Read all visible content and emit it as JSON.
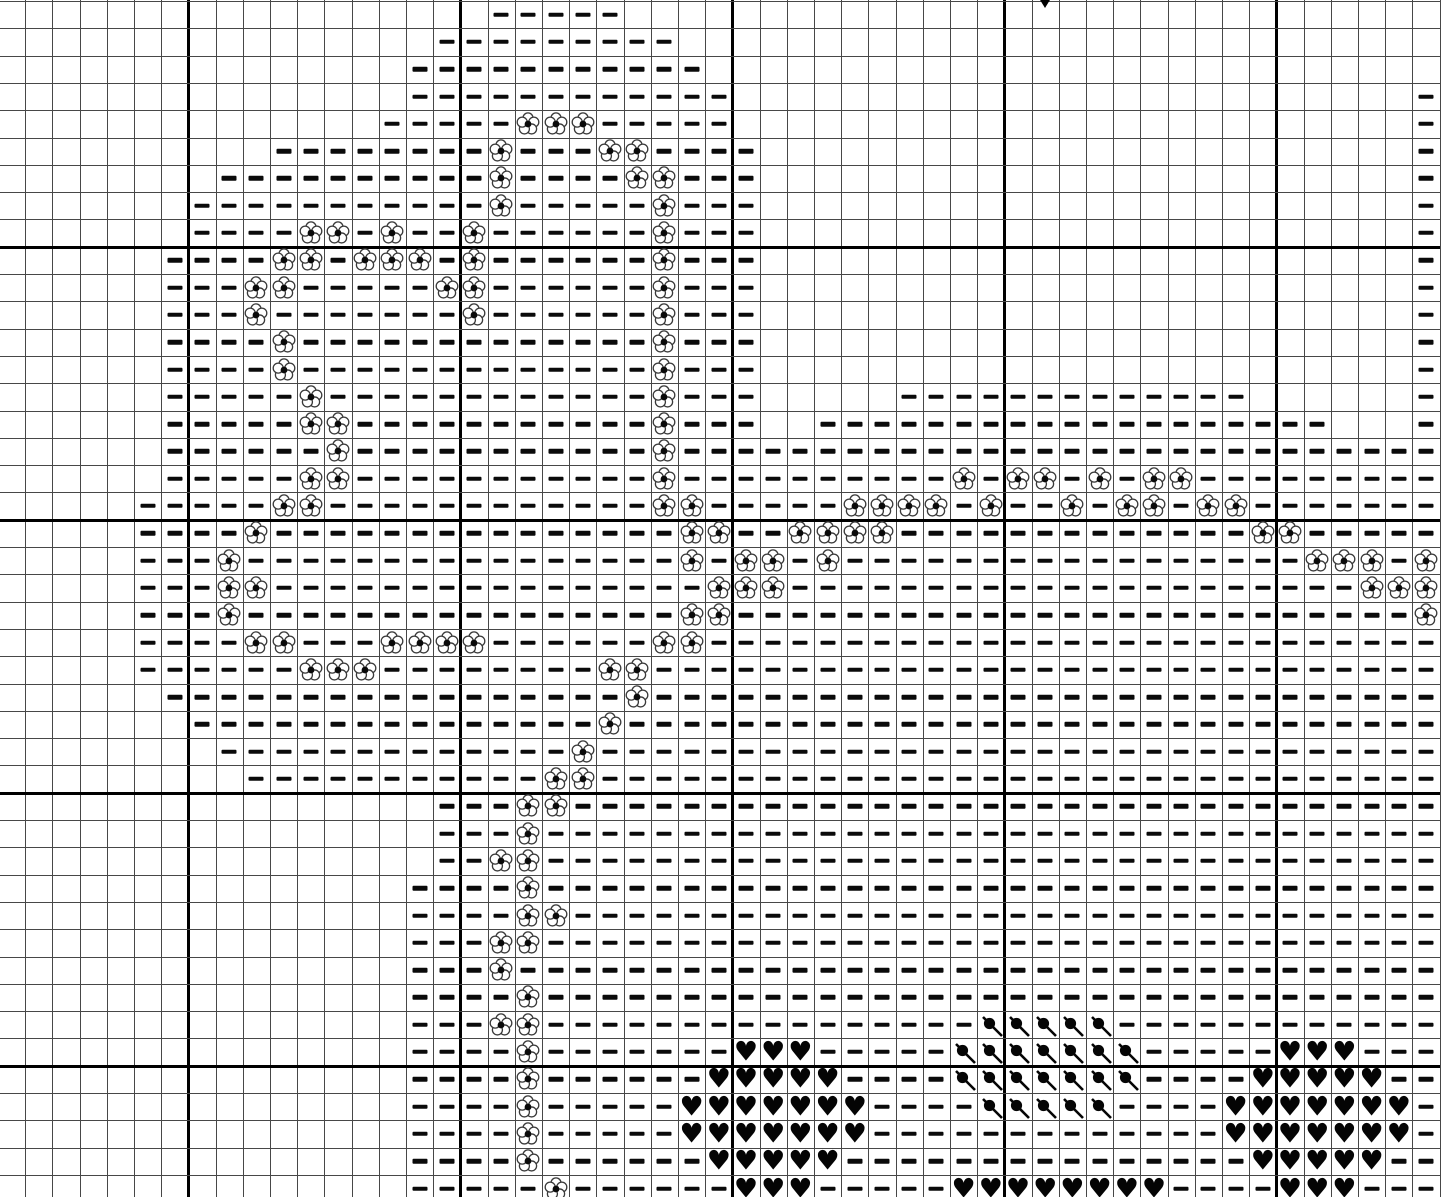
{
  "chart_data": {
    "type": "heatmap",
    "title": "cross-stitch pattern chart (floral sprays with hearts border)",
    "rows": 44,
    "cols": 53,
    "major_grid_every": 10,
    "major_col_boundaries": [
      7,
      17,
      27,
      37,
      47
    ],
    "major_row_boundaries": [
      9,
      19,
      29,
      39
    ],
    "legend": {
      ".": "empty cell",
      "-": "dash stitch symbol",
      "f": "flower stitch symbol",
      "h": "heart stitch symbol",
      "d": "diagonal (slash-and-dot) stitch symbol"
    },
    "colors": {
      "symbol": "#0a0a0a",
      "grid_thin": "#474747",
      "grid_thick": "#000000",
      "background": "#ffffff"
    },
    "center_marker": {
      "column": 38,
      "shape": "down-triangle"
    },
    "grid": [
      "..................-----..............................",
      "................---------............................",
      "...............-----------...........................",
      "...............------------.........................-",
      "..............-----fff-----.........................-",
      "..........--------f---ff----........................-",
      "........----------f----ff---........................-",
      ".......-----------f-----f---........................-",
      ".......----ff-f--f------f---........................-",
      "......----ff-fff-f------f---........................-",
      "......---ff-----ff------f---........................-",
      "......---f-------f------f---........................-",
      "......----f-------------f---........................-",
      "......----f-------------f---........................-",
      "......-----f------------f---.....-------------......-",
      "......-----ff-----------f---..-------------------...-",
      "......------f-----------f----------------------------",
      "......-----ff-----------f----------f-ff-f-ff---------",
      ".....-----ff------------ff-----ffff-f--f-ff-ff-------",
      ".....----f---------------ff--ffff-------------ff-----",
      ".....---f----------------f-ff-f-----------------fff-f",
      ".....---ff----------------fff---------------------fff",
      ".....---f----------------ff-------------------------f",
      ".....----ff---ffff------ff---------------------------",
      ".....------fff--------ff-----------------------------",
      "......-----------------f-----------------------------",
      ".......---------------f------------------------------",
      "........-------------f-------------------------------",
      ".........-----------ff-------------------------------",
      "................---ff--------------------------------",
      "................---f---------------------------------",
      "................--ff---------------------------------",
      "...............----f---------------------------------",
      "...............----ff--------------------------------",
      "...............---ff---------------------------------",
      "...............---f----------------------------------",
      "...............----f---------------------------------",
      "...............---ff----------------ddddd------------",
      "...............----f-------hhh-----ddddddd-----hhh---",
      "...............----f------hhhhh----ddddddd----hhhhh--",
      "...............----f-----hhhhhhh----ddddd----hhhhhhh-",
      "...............----f-----hhhhhhh-------------hhhhhhh-",
      "...............----f------hhhhh---------------hhhhh--",
      "...............-----f------hhh-----hhhhhhhh----hhh---"
    ]
  }
}
